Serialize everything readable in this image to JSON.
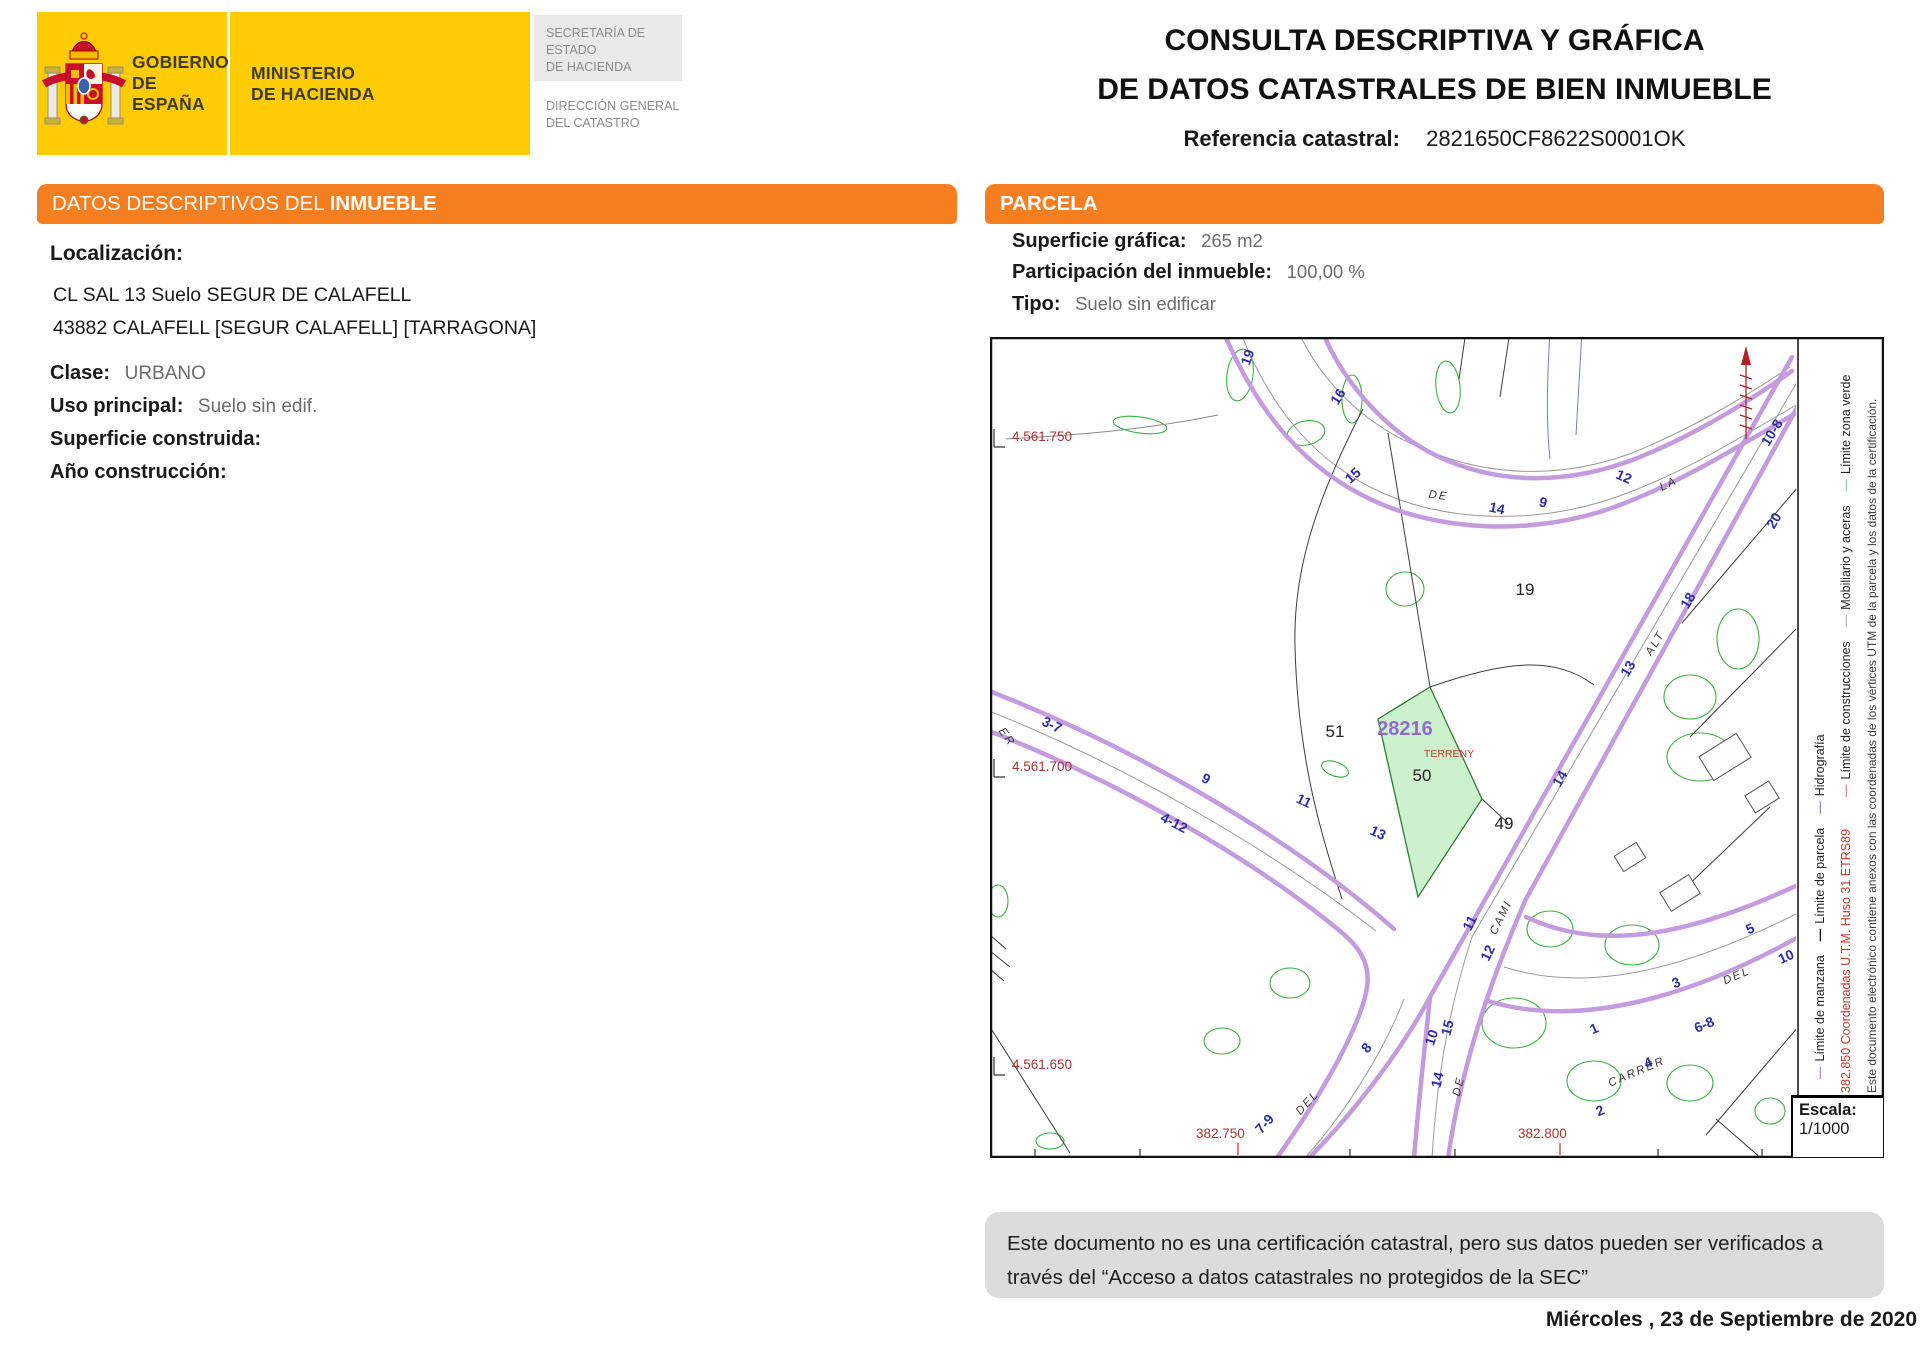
{
  "header": {
    "gobierno_line1": "GOBIERNO",
    "gobierno_line2": "DE ESPAÑA",
    "ministerio_line1": "MINISTERIO",
    "ministerio_line2": "DE HACIENDA",
    "secretaria_line1": "SECRETARÍA DE ESTADO",
    "secretaria_line2": "DE HACIENDA",
    "direccion_line1": "DIRECCIÓN GENERAL",
    "direccion_line2": "DEL CATASTRO",
    "title_line1": "CONSULTA DESCRIPTIVA Y GRÁFICA",
    "title_line2": "DE DATOS CATASTRALES DE BIEN INMUEBLE",
    "referencia_label": "Referencia catastral:",
    "referencia_value": "2821650CF8622S0001OK"
  },
  "datos_panel": {
    "title_regular": "DATOS DESCRIPTIVOS DEL ",
    "title_bold": "INMUEBLE",
    "localizacion_label": "Localización:",
    "address_line1": "CL SAL 13 Suelo SEGUR DE CALAFELL",
    "address_line2": "43882 CALAFELL [SEGUR CALAFELL] [TARRAGONA]",
    "fields": [
      {
        "label": "Clase:",
        "value": "URBANO"
      },
      {
        "label": "Uso principal:",
        "value": "Suelo sin edif."
      },
      {
        "label": "Superficie construida:",
        "value": ""
      },
      {
        "label": "Año construcción:",
        "value": ""
      }
    ]
  },
  "parcela_panel": {
    "title": "PARCELA",
    "fields": [
      {
        "label": "Superficie gráfica:",
        "value": "265 m2"
      },
      {
        "label": "Participación del inmueble:",
        "value": "100,00 %"
      },
      {
        "label": "Tipo:",
        "value": "Suelo sin edificar"
      }
    ]
  },
  "map": {
    "highlight_parcel_ref": "28216",
    "highlight_parcel_note": "TERRENY",
    "utm_y_coords": [
      "4.561.750",
      "4.561.700",
      "4.561.650"
    ],
    "utm_x_coords": [
      "382.750",
      "382.800"
    ],
    "escala_label": "Escala:",
    "escala_value": "1/1000",
    "legend_coord_note": "382.850 Coordenadas U.T.M. Huso 31 ETRS89",
    "legend_line1_items": [
      {
        "dash_color": "#b98fd9",
        "label": "Límite de manzana"
      },
      {
        "dash_color": "#111111",
        "label": "Límite de parcela"
      },
      {
        "dash_color": "#7d9bd2",
        "label": "Hidrografía"
      }
    ],
    "legend_line2_items": [
      {
        "dash_color": "#e08a8a",
        "label": "Límite de construcciones"
      },
      {
        "dash_color": "#bdbdbd",
        "label": "Mobiliario y aceras"
      },
      {
        "dash_color": "#8fd4b0",
        "label": "Límite zona verde"
      }
    ],
    "legend_note": "Este documento electrónico contiene anexos con las coordenadas de los vértices UTM de la parcela y los datos de la certificación.",
    "labels": [
      {
        "t": "4.561.750",
        "x": 22,
        "y": 104,
        "r": 0,
        "c": "coord"
      },
      {
        "t": "4.561.700",
        "x": 22,
        "y": 434,
        "r": 0,
        "c": "coord"
      },
      {
        "t": "4.561.650",
        "x": 22,
        "y": 732,
        "r": 0,
        "c": "coord"
      },
      {
        "t": "382.750",
        "x": 206,
        "y": 801,
        "r": 0,
        "c": "coord"
      },
      {
        "t": "382.800",
        "x": 528,
        "y": 801,
        "r": 0,
        "c": "coord"
      },
      {
        "t": "19",
        "x": 262,
        "y": 22,
        "r": -70,
        "c": "num"
      },
      {
        "t": "16",
        "x": 352,
        "y": 62,
        "r": -58,
        "c": "num"
      },
      {
        "t": "15",
        "x": 366,
        "y": 142,
        "r": -42,
        "c": "num"
      },
      {
        "t": "14",
        "x": 506,
        "y": 176,
        "r": 12,
        "c": "num"
      },
      {
        "t": "12",
        "x": 632,
        "y": 144,
        "r": 24,
        "c": "num"
      },
      {
        "t": "9",
        "x": 552,
        "y": 170,
        "r": 14,
        "c": "num"
      },
      {
        "t": "10-8",
        "x": 786,
        "y": 98,
        "r": -59,
        "c": "num"
      },
      {
        "t": "20",
        "x": 788,
        "y": 186,
        "r": -59,
        "c": "num"
      },
      {
        "t": "18",
        "x": 702,
        "y": 266,
        "r": -59,
        "c": "num"
      },
      {
        "t": "13",
        "x": 642,
        "y": 334,
        "r": -59,
        "c": "num"
      },
      {
        "t": "14",
        "x": 574,
        "y": 444,
        "r": -59,
        "c": "num"
      },
      {
        "t": "11",
        "x": 484,
        "y": 588,
        "r": -64,
        "c": "num"
      },
      {
        "t": "12",
        "x": 502,
        "y": 618,
        "r": -64,
        "c": "num"
      },
      {
        "t": "10",
        "x": 446,
        "y": 702,
        "r": -72,
        "c": "num"
      },
      {
        "t": "3-7",
        "x": 60,
        "y": 392,
        "r": 26,
        "c": "num"
      },
      {
        "t": "9",
        "x": 214,
        "y": 446,
        "r": 26,
        "c": "num"
      },
      {
        "t": "11",
        "x": 312,
        "y": 468,
        "r": 25,
        "c": "num"
      },
      {
        "t": "13",
        "x": 386,
        "y": 500,
        "r": 25,
        "c": "num"
      },
      {
        "t": "4-12",
        "x": 182,
        "y": 490,
        "r": 27,
        "c": "num"
      },
      {
        "t": "7-9",
        "x": 278,
        "y": 790,
        "r": -48,
        "c": "num"
      },
      {
        "t": "8",
        "x": 380,
        "y": 714,
        "r": -48,
        "c": "num"
      },
      {
        "t": "15",
        "x": 462,
        "y": 692,
        "r": -76,
        "c": "num"
      },
      {
        "t": "14",
        "x": 452,
        "y": 744,
        "r": -76,
        "c": "num"
      },
      {
        "t": "1",
        "x": 606,
        "y": 696,
        "r": -23,
        "c": "num"
      },
      {
        "t": "3",
        "x": 688,
        "y": 650,
        "r": -23,
        "c": "num"
      },
      {
        "t": "5",
        "x": 762,
        "y": 596,
        "r": -24,
        "c": "num"
      },
      {
        "t": "10",
        "x": 798,
        "y": 624,
        "r": -24,
        "c": "num"
      },
      {
        "t": "6-8",
        "x": 716,
        "y": 692,
        "r": -23,
        "c": "num"
      },
      {
        "t": "4",
        "x": 660,
        "y": 730,
        "r": -23,
        "c": "num"
      },
      {
        "t": "2",
        "x": 612,
        "y": 778,
        "r": -23,
        "c": "num"
      },
      {
        "t": "DE",
        "x": 448,
        "y": 162,
        "r": 8,
        "c": "street"
      },
      {
        "t": "LA",
        "x": 680,
        "y": 150,
        "r": -26,
        "c": "street"
      },
      {
        "t": "ALT",
        "x": 668,
        "y": 308,
        "r": -59,
        "c": "street"
      },
      {
        "t": "CAMI",
        "x": 514,
        "y": 582,
        "r": -64,
        "c": "street"
      },
      {
        "t": "ER",
        "x": 14,
        "y": 402,
        "r": 55,
        "c": "street"
      },
      {
        "t": "DEL",
        "x": 320,
        "y": 768,
        "r": -48,
        "c": "street"
      },
      {
        "t": "DE",
        "x": 472,
        "y": 750,
        "r": -76,
        "c": "street"
      },
      {
        "t": "CARRER",
        "x": 648,
        "y": 738,
        "r": -23,
        "c": "street"
      },
      {
        "t": "DEL",
        "x": 748,
        "y": 642,
        "r": -23,
        "c": "street"
      },
      {
        "t": "19",
        "x": 535,
        "y": 258,
        "r": 0,
        "c": "pnum"
      },
      {
        "t": "51",
        "x": 345,
        "y": 400,
        "r": 0,
        "c": "pnum"
      },
      {
        "t": "50",
        "x": 432,
        "y": 444,
        "r": 0,
        "c": "pnum"
      },
      {
        "t": "49",
        "x": 514,
        "y": 492,
        "r": 0,
        "c": "pnum"
      },
      {
        "t": "28216",
        "x": 415,
        "y": 398,
        "r": 0,
        "c": "ref"
      },
      {
        "t": "TERRENY",
        "x": 459,
        "y": 420,
        "r": 0,
        "c": "terr"
      }
    ]
  },
  "footer": {
    "disclaimer_line1": "Este documento no es una certificación catastral, pero sus datos pueden ser verificados a",
    "disclaimer_line2": "través del “Acceso a datos catastrales no protegidos de la SEC”",
    "date": "Miércoles , 23 de Septiembre de 2020"
  },
  "colors": {
    "section_header_orange": "#f57e20",
    "logo_yellow": "#ffcb05",
    "manzana_purple": "#c49bde",
    "highlight_green_fill": "#cdf0cd",
    "street_number_blue": "#2d2da8",
    "utm_coord_red": "#a93333",
    "parcel_ref_purple": "#8f6bd0"
  }
}
